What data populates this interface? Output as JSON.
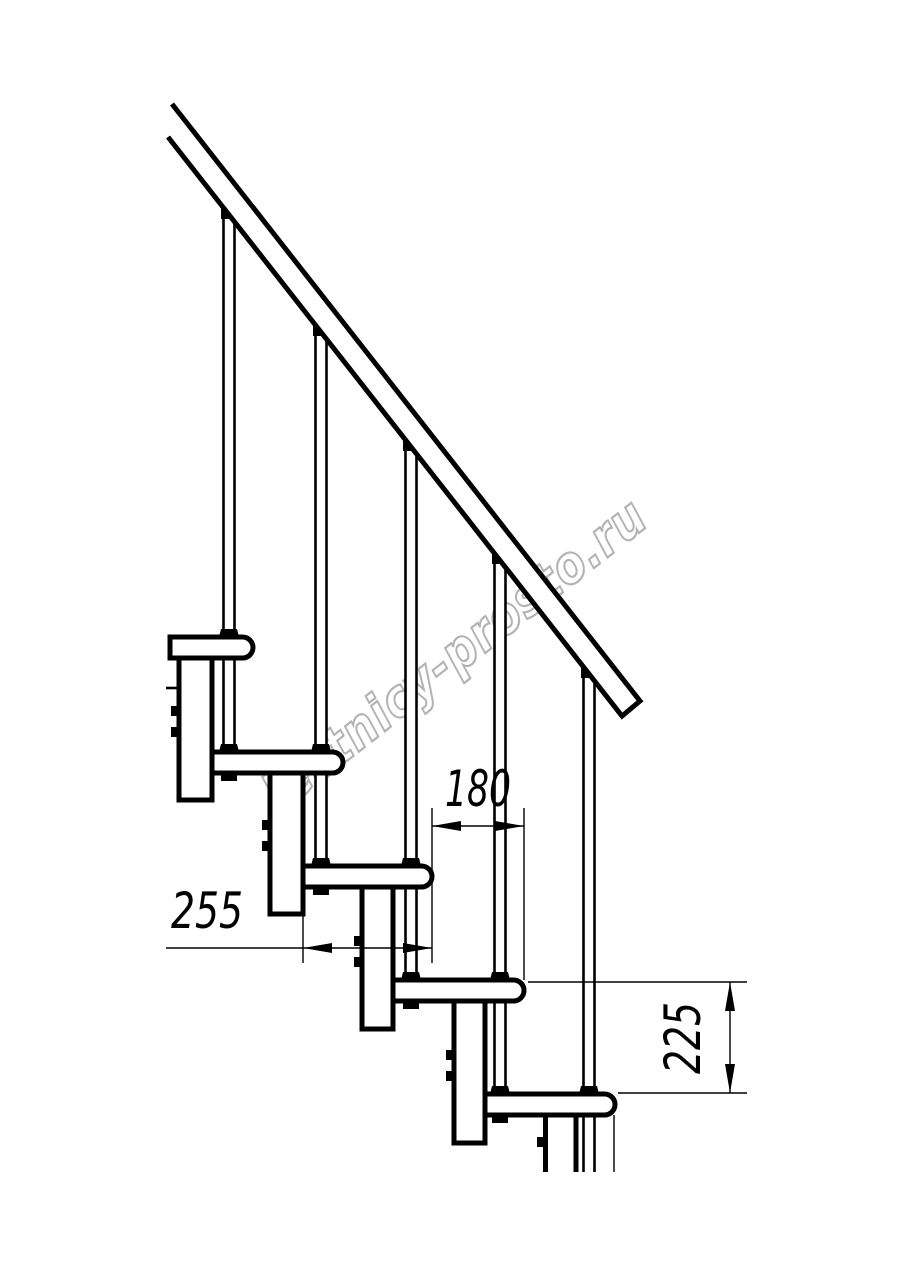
{
  "drawing": {
    "title_hint": "modular staircase side view",
    "watermark": "lestnicy-prosto.ru",
    "dimensions": {
      "step_run": "180",
      "tread_depth": "255",
      "step_rise": "225"
    },
    "colors": {
      "line": "#000000",
      "watermark": "#b3b3b3",
      "background": "#ffffff"
    }
  }
}
